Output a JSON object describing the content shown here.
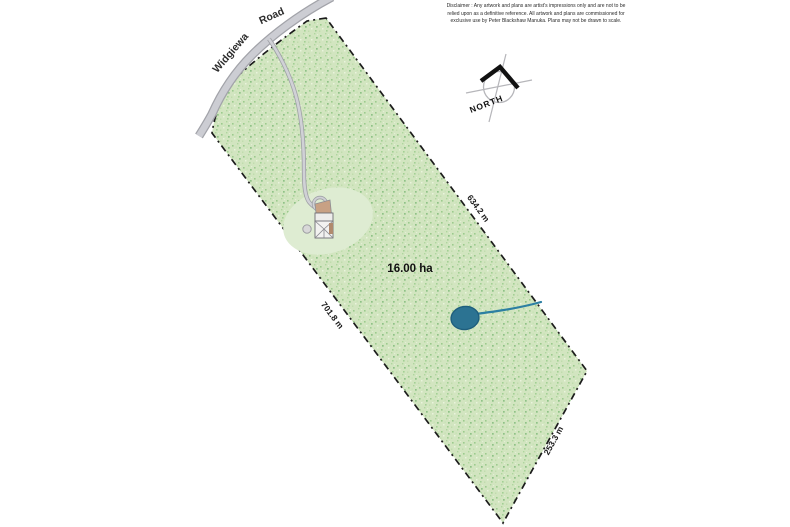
{
  "plan": {
    "area_label": "16.00 ha",
    "road_name": {
      "part1": "Widgiewa",
      "part2": "Road"
    },
    "boundary_lengths": {
      "northeast_edge": "634.2 m",
      "southwest_edge": "701.8 m",
      "southeast_edge": "253.3 m"
    },
    "compass_label": "NORTH"
  },
  "disclaimer": {
    "line1": "Disclaimer : Any artwork and plans are artist's impressions only and are not to be",
    "line2": "relied upon as a definitive reference. All artwork and plans are commissioned for",
    "line3": "exclusive use by Peter Blackshaw Manuka. Plans may not be drawn to scale."
  },
  "colors": {
    "parcel_green_base": "#d2e5c0",
    "cleared_green": "#deecd2",
    "dam_blue": "#2c7392",
    "creek_blue": "#2c7fa2",
    "road_gray_fill": "#cccdd3",
    "road_gray_casing": "#a2a3a9",
    "boundary_black": "#1c1c1c",
    "courtyard_tan": "#c8a184"
  }
}
